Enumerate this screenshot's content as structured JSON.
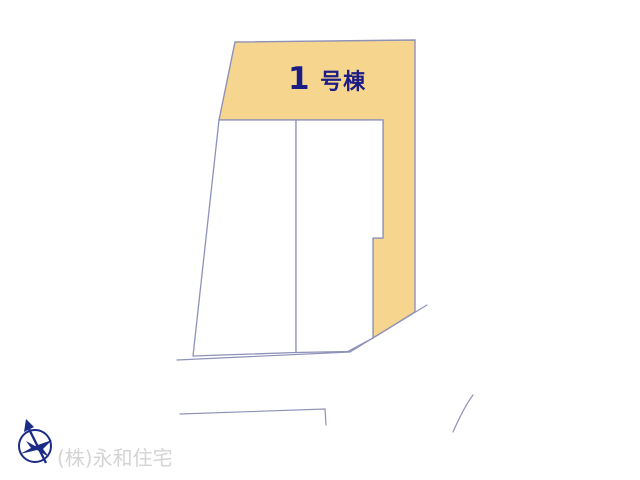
{
  "labels": {
    "building_number": "1",
    "building_suffix": "号棟",
    "watermark": "(株)永和住宅"
  },
  "icons": {
    "compass": "compass-north-icon"
  },
  "colors": {
    "background": "#FFFFFF",
    "parcel_fill": "#F6D68F",
    "line": "#8F92B8",
    "label_text": "#1C1C85",
    "compass": "#1B2C87",
    "watermark": "#D4D4D4"
  }
}
